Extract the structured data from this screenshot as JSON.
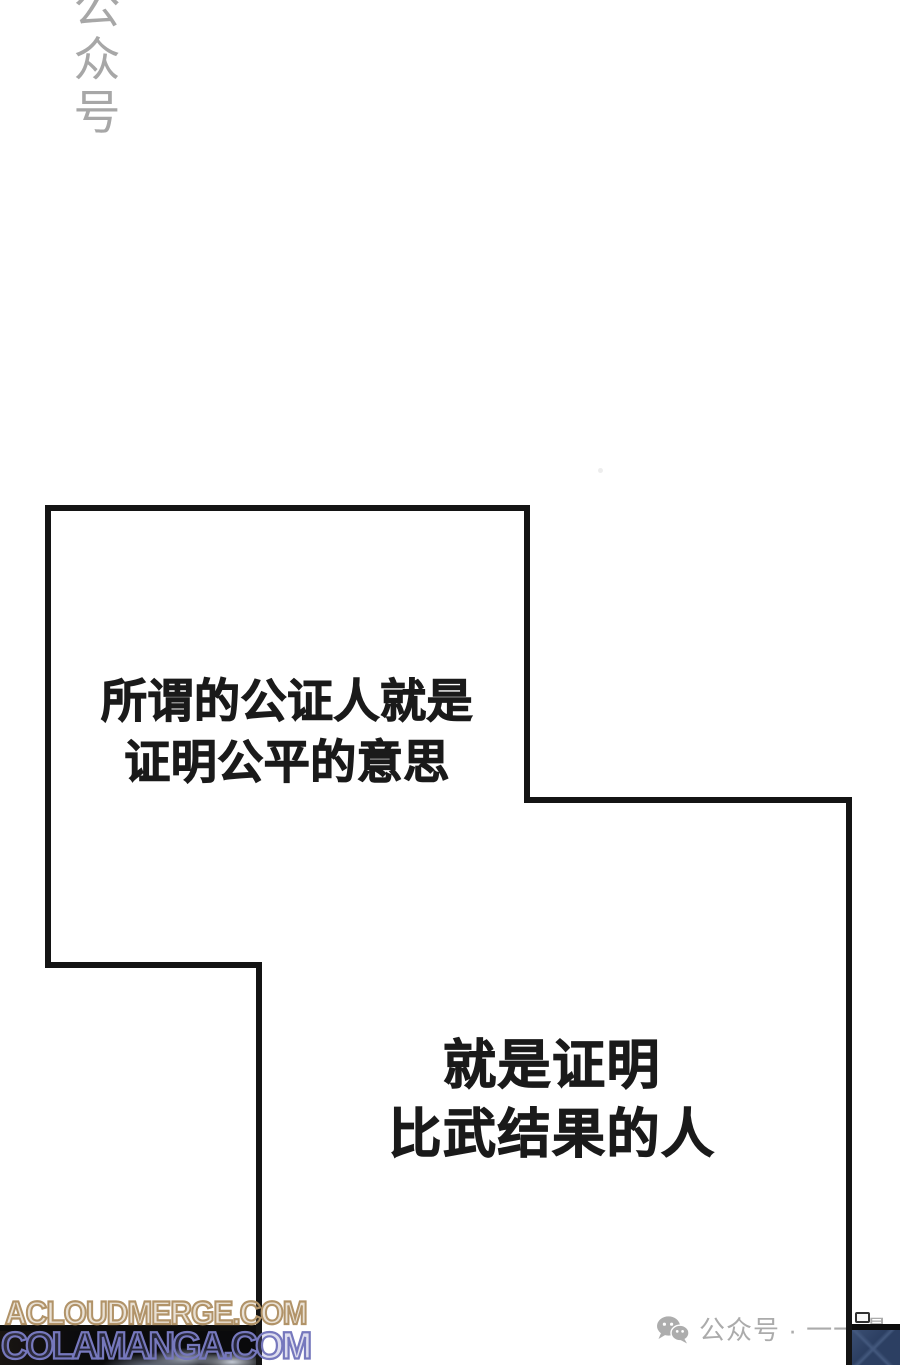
{
  "page": {
    "background": "#ffffff",
    "width": 900,
    "height": 1365
  },
  "panel": {
    "border_color": "#141414",
    "border_width": 6
  },
  "dialogues": [
    {
      "line1": "所谓的公证人就是",
      "line2": "证明公平的意思"
    },
    {
      "line1": "就是证明",
      "line2": "比武结果的人"
    }
  ],
  "watermarks": {
    "vertical": {
      "text": "公众号",
      "chars": [
        "公",
        "众",
        "号"
      ],
      "color": "#a3a3a3"
    },
    "bottom": [
      {
        "text": "ACLOUDMERGE.COM",
        "color": "#b19368"
      },
      {
        "text": "COLAMANGA.COM",
        "color": "#7678bd"
      }
    ],
    "wechat": {
      "label": "公众号 · 一一漫",
      "color": "#ababab",
      "icon": "wechat-chat-bubbles"
    }
  },
  "artwork": {
    "bottom_left_base": "#0b0b0d",
    "bottom_left_highlight": "#c3c9d4",
    "bottom_right_base": "#2c3f62"
  },
  "text_color": "#1a1a1a"
}
